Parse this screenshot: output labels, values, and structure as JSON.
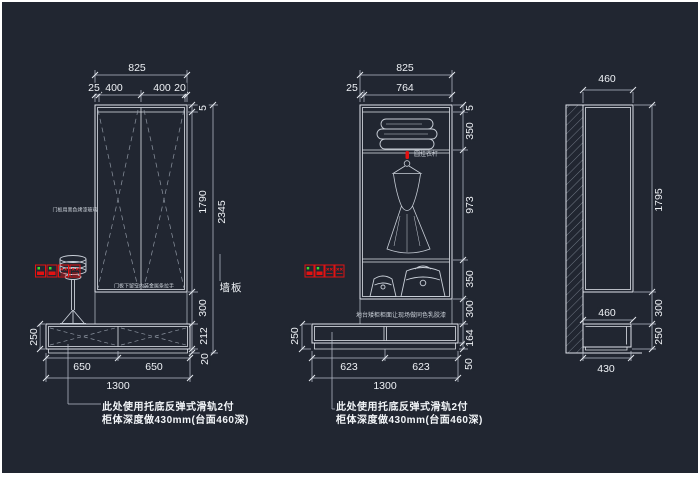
{
  "canvas": {
    "background": "#212631",
    "line_color": "#dfe3ea",
    "dim_line_color": "#b6bdc9",
    "text_color": "#eef1f5",
    "accent_red": "#e31212",
    "accent_green": "#3ddc33"
  },
  "left_view": {
    "width_total": "825",
    "width_segments": [
      "25",
      "400",
      "400",
      "20"
    ],
    "height_total": "2345",
    "height_segments": [
      "5",
      "1790",
      "300",
      "212",
      "20"
    ],
    "base_height": "250",
    "base_segments": [
      "650",
      "650"
    ],
    "base_total": "1300",
    "wall_label": "墙板",
    "door_note": "门板用黑色烤漆玻璃",
    "handle_note": "门板下留空内装金属条拉手",
    "callout": [
      "此处使用托底反弹式滑轨2付",
      "柜体深度做430mm(台面460深)"
    ]
  },
  "middle_view": {
    "width_total": "825",
    "width_segments": [
      "25",
      "764"
    ],
    "height_segments": [
      "5",
      "350",
      "973",
      "350",
      "300",
      "164",
      "50"
    ],
    "base_height": "250",
    "base_segments": [
      "623",
      "623"
    ],
    "base_total": "1300",
    "rod_label": "圆挂衣杆",
    "counter_note": "地台矮柜柜面让现场做同色乳胶漆",
    "callout": [
      "此处使用托底反弹式滑轨2付",
      "柜体深度做430mm(台面460深)"
    ]
  },
  "right_view": {
    "width_top": "460",
    "height": "1795",
    "gap": "300",
    "base_height": "250",
    "counter_depth": "460",
    "base_depth": "430"
  }
}
